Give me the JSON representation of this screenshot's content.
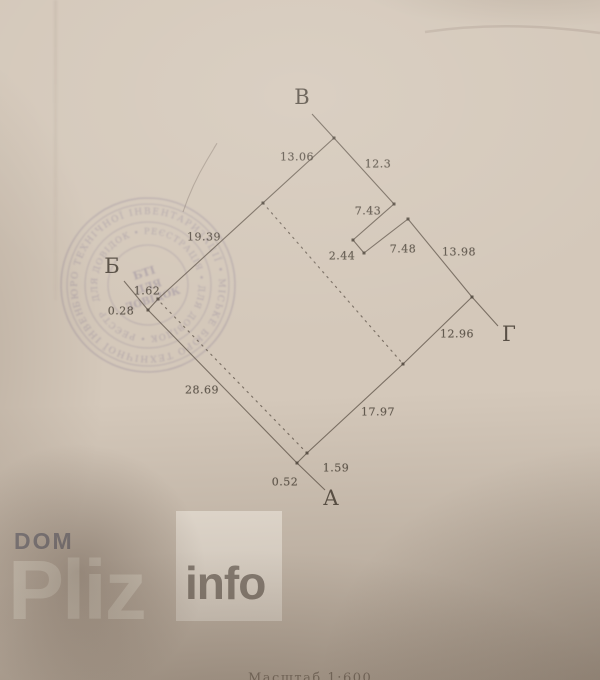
{
  "colors": {
    "paper": "#d4c8ba",
    "line": "#6b6055",
    "dash": "#6f6459",
    "dot": "#554c42",
    "label_text": "#544c42",
    "corner_text": "#4c443a",
    "stamp": "#8d8196",
    "watermark_gray": "#85858d",
    "watermark_cream": "#ece4d4",
    "info_box": "#efe8da",
    "info_text": "#8f867d",
    "scale_text": "rgba(90,80,70,0.6)"
  },
  "plan": {
    "corner_labels": [
      {
        "text": "В",
        "x": 302,
        "y": 97
      },
      {
        "text": "Б",
        "x": 112,
        "y": 266
      },
      {
        "text": "Г",
        "x": 509,
        "y": 334
      },
      {
        "text": "А",
        "x": 331,
        "y": 498
      }
    ],
    "measurements": [
      {
        "text": "13.06",
        "x": 297,
        "y": 157
      },
      {
        "text": "12.3",
        "x": 378,
        "y": 164
      },
      {
        "text": "19.39",
        "x": 204,
        "y": 237
      },
      {
        "text": "7.43",
        "x": 368,
        "y": 211
      },
      {
        "text": "2.44",
        "x": 342,
        "y": 256
      },
      {
        "text": "7.48",
        "x": 403,
        "y": 249
      },
      {
        "text": "13.98",
        "x": 459,
        "y": 252
      },
      {
        "text": "12.96",
        "x": 457,
        "y": 334
      },
      {
        "text": "17.97",
        "x": 378,
        "y": 412
      },
      {
        "text": "28.69",
        "x": 202,
        "y": 390
      },
      {
        "text": "1.62",
        "x": 147,
        "y": 291
      },
      {
        "text": "0.28",
        "x": 121,
        "y": 311
      },
      {
        "text": "1.59",
        "x": 336,
        "y": 468
      },
      {
        "text": "0.52",
        "x": 285,
        "y": 482
      }
    ],
    "solid_lines": [
      [
        312,
        114,
        334,
        138
      ],
      [
        334,
        138,
        158,
        299
      ],
      [
        334,
        138,
        394,
        204
      ],
      [
        394,
        204,
        353,
        240
      ],
      [
        353,
        240,
        364,
        253
      ],
      [
        364,
        253,
        408,
        219
      ],
      [
        408,
        219,
        472,
        297
      ],
      [
        472,
        297,
        498,
        326
      ],
      [
        472,
        297,
        403,
        364
      ],
      [
        403,
        364,
        307,
        453
      ],
      [
        307,
        453,
        297,
        463
      ],
      [
        297,
        463,
        325,
        490
      ],
      [
        297,
        463,
        148,
        310
      ],
      [
        148,
        310,
        158,
        299
      ],
      [
        124,
        281,
        148,
        310
      ]
    ],
    "dashed_lines": [
      [
        263,
        203,
        403,
        364
      ],
      [
        161,
        303,
        305,
        451
      ]
    ],
    "points": [
      [
        334,
        138
      ],
      [
        263,
        203
      ],
      [
        394,
        204
      ],
      [
        353,
        240
      ],
      [
        364,
        253
      ],
      [
        408,
        219
      ],
      [
        472,
        297
      ],
      [
        403,
        364
      ],
      [
        307,
        453
      ],
      [
        297,
        463
      ],
      [
        158,
        299
      ],
      [
        148,
        310
      ]
    ],
    "scale_note": "Масштаб 1:600"
  },
  "stamp": {
    "cx": 148,
    "cy": 285,
    "ring_text_outer": "БЮРО ТЕХНІЧНОЇ ІНВЕНТАРИЗАЦІЇ • МІСЬКЕ БЮРО ТЕХНІЧНОЇ ІНВЕНТАРИЗАЦІЇ •",
    "ring_text_inner": "ДЛЯ ДОВІДОК • РЕЄСТРАЦІЯ • ДЛЯ ДОВІДОК • РЕЄСТР",
    "center_lines": [
      "БТІ",
      "ДЛЯ",
      "ДОВІДОК"
    ]
  },
  "watermark": {
    "dom": "DOM",
    "pliz": "Pliz",
    "info": "info"
  }
}
